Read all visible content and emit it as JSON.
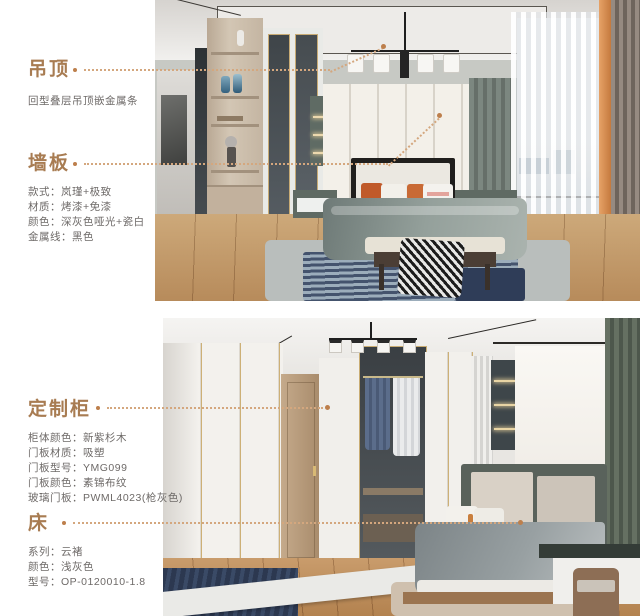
{
  "palette": {
    "heading": "#a87c52",
    "body_text": "#6e6a68",
    "leader_line": "#d4a77e",
    "marker_dot": "#bd7f4c",
    "background": "#ffffff"
  },
  "sections": {
    "ceiling": {
      "title": "吊顶",
      "desc": "回型叠层吊顶嵌金属条"
    },
    "wall_panel": {
      "title": "墙板",
      "specs": [
        {
          "label": "款式：",
          "value": "岚瑾+极致"
        },
        {
          "label": "材质：",
          "value": "烤漆+免漆"
        },
        {
          "label": "颜色：",
          "value": "深灰色哑光+瓷白"
        },
        {
          "label": "金属线：",
          "value": "黑色"
        }
      ]
    },
    "custom_cabinet": {
      "title": "定制柜",
      "specs": [
        {
          "label": "柜体颜色：",
          "value": "新紫杉木"
        },
        {
          "label": "门板材质：",
          "value": "吸塑"
        },
        {
          "label": "门板型号：",
          "value": "YMG099"
        },
        {
          "label": "门板颜色：",
          "value": "素锦布纹"
        },
        {
          "label": "玻璃门板：",
          "value": "PWML4023(枪灰色)"
        }
      ]
    },
    "bed": {
      "title": "床",
      "specs": [
        {
          "label": "系列：",
          "value": "云褚"
        },
        {
          "label": "颜色：",
          "value": "浅灰色"
        },
        {
          "label": "型号：",
          "value": "OP-0120010-1.8"
        }
      ]
    }
  }
}
